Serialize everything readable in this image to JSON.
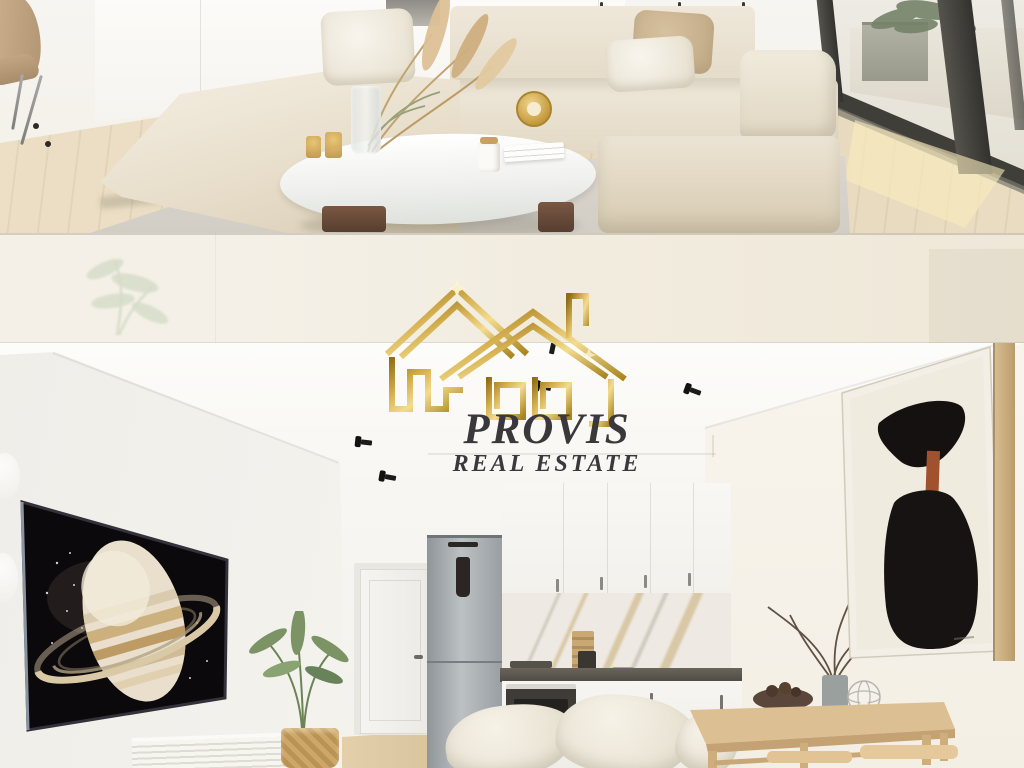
{
  "canvas": {
    "width_px": 1024,
    "height_px": 768
  },
  "watermark": {
    "brand": "PROVIS",
    "tagline": "REAL ESTATE",
    "logo_icon": "gold-wireframe-house-logo",
    "text_color_hex": "#3a383b",
    "gold_hex": "#c8a345"
  },
  "divider_band": {
    "background_hex": "#f2ede2"
  },
  "photo_top": {
    "alt": "Render of a bright living room: beige modular sofa with cushions, round white coffee table with pampas grass vase, candles and clock, wooden chair at left, floor-to-ceiling glass wall to a patio with a planter"
  },
  "photo_bottom": {
    "alt": "Render of an open-plan room: large Saturn artwork screen on the left wall above a ribbed console, white kitchen with steel fridge, marble splashback and dark counter, wooden dining table with branches in a vase, black abstract painting on the right wall"
  }
}
